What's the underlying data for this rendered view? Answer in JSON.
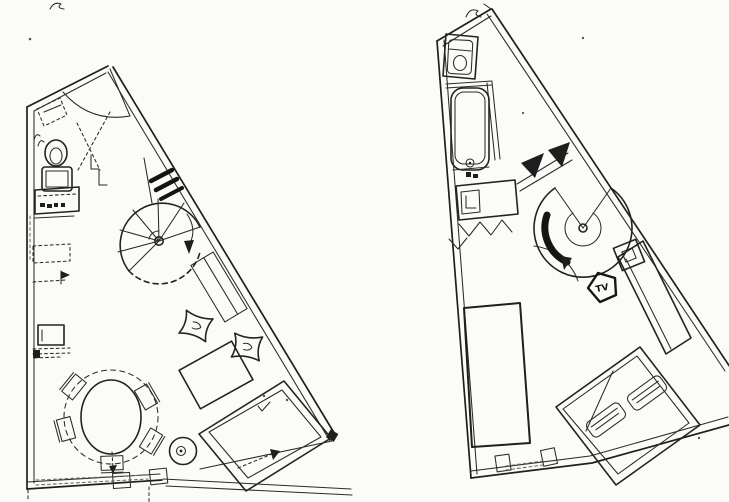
{
  "document": {
    "kind": "scanned hand-drawn floor plans (two levels of a duplex apartment)",
    "background_color": "#fbfbf8",
    "ink_color": "#232323"
  },
  "labels": {
    "tv_badge": "TV"
  },
  "plans": {
    "left": {
      "name": "main-living-level",
      "features": [
        "entry-door",
        "corner-shelf",
        "wc-toilet",
        "kitchen-counters",
        "refrigerator",
        "spiral-staircase",
        "window-hatch",
        "wall-bench",
        "round-dining-table",
        "dining-chairs",
        "floor-cushions",
        "coffee-table",
        "sofa",
        "round-side-table",
        "window-wall"
      ]
    },
    "right": {
      "name": "upper-bedroom-level",
      "features": [
        "toilet",
        "bathtub",
        "vanity-sink",
        "partition-wall",
        "spiral-staircase",
        "tv-pedestal",
        "tv-stand",
        "desk-shelf",
        "wardrobe",
        "double-bed",
        "pillows",
        "window-wall"
      ]
    }
  }
}
